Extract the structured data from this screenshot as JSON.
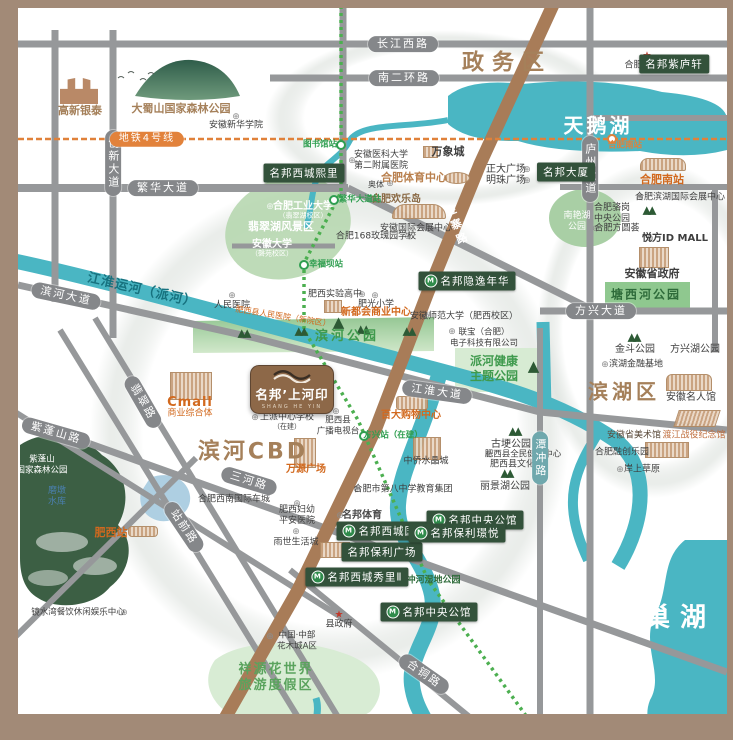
{
  "logo": {
    "name": "名邦’上河印",
    "sub": "SHANG HE YIN"
  },
  "districts": {
    "zhengwuqu": "政务区",
    "tianehu": "天鹅湖",
    "binhecbd": "滨河CBD",
    "binhuqu": "滨湖区",
    "chaohu": "巢湖"
  },
  "waters": {
    "canal": "江淮运河（派河）",
    "reservoir_l1": "磨墩",
    "reservoir_l2": "水库"
  },
  "roads": {
    "changjiangxilu": "长江西路",
    "nanerhuanlu": "南二环路",
    "fanhuadadao": "繁华大道",
    "chuangxindadao": "创新大道",
    "luzhoudadao": "庐州大道",
    "binhedadao": "滨河大道",
    "jianghuaidadao": "江淮大道",
    "fangxingdadao": "方兴大道",
    "sanhelu": "三河路",
    "zipengshanlu": "紫蓬山路",
    "feicuilu": "翡翠路",
    "zhanqianlu": "站前路",
    "hetonglu": "合铜路",
    "jinzhailu": "金寨路",
    "tanchonglu": "潭冲路"
  },
  "metro": {
    "line4": "地铁4号线",
    "st_tushuguan": "图书馆站",
    "st_fanhuadadao": "繁华大道站",
    "st_xingfuba": "幸福坝站",
    "st_fangxing": "方兴站（在建）",
    "st_hefeinan": "合肥南站"
  },
  "badges": {
    "ziluxuan": "名邦紫庐轩",
    "daxia": "名邦大厦",
    "xichengxili": "名邦西城熙里",
    "yinyinianhua": "名邦隐逸年华",
    "xichengguoji": "名邦西城国际",
    "baoliguangchang": "名邦保利广场",
    "xichengxiuli2": "名邦西城秀里Ⅱ",
    "zhongyanggongguan": "名邦中央公馆",
    "baolijingyue": "名邦保利璟悦",
    "zhongyanggongguan2": "名邦中央公馆"
  },
  "pois": {
    "gaoxinyintai": "高新银泰",
    "dashushan": "大蜀山国家森林公园",
    "xinhuaxueyuan": "安徽新华学院",
    "shizhengfu": "合肥市政府",
    "yikeda_l1": "安徽医科大学",
    "yikeda_l2": "第二附属医院",
    "wanxiangcheng": "万象城",
    "tiyuzhongxin": "合肥体育中心",
    "aoti": "奥体",
    "huanledao": "合肥欢乐岛",
    "guojihuizhan": "安徽国际会展中心",
    "rose168": "合肥168玫瑰园学校",
    "zhengdaguangchang": "正大广场",
    "mingzhuguangchang": "明珠广场",
    "hefeinanzhan": "合肥南站",
    "binhuhuizhan": "合肥滨湖国际会展中心",
    "luogang_l1": "合肥骆岗",
    "luogang_l2": "中央公园",
    "nanyanhu_l1": "南艳湖",
    "nanyanhu_l2": "公园",
    "fangyuanhui": "合肥方圆荟",
    "yuefangidmall": "悦方ID MALL",
    "shengzhengfu": "安徽省政府",
    "tangxihegongyuan": "塘西河公园",
    "jindougongyuan": "金斗公园",
    "fangxinghugongyuan": "方兴湖公园",
    "binhujinrongjidi": "滨湖金融基地",
    "mingrenguan": "安徽名人馆",
    "meishuguan": "安徽省美术馆",
    "dujiang": "渡江战役纪念馆",
    "rongchuangleyuan": "合肥融创乐园",
    "anshangcaoyuan": "岸上草原",
    "hegongda": "合肥工业大学",
    "hegongda_sub": "（翡翠湖校区）",
    "feicuihu": "翡翠湖风景区",
    "anhuidaxue": "安徽大学",
    "anhuidaxue_sub": "（磬苑校区）",
    "renminyiyuan": "人民医院",
    "feixirenmin": "肥西县人民医院（新院区）",
    "binhegongyuan": "滨河公园",
    "shiyangaozhong": "肥西实验高中",
    "feiguangxiaoxue": "肥光小学",
    "xinduhui": "新都会商业中心",
    "lianbao_l1": "联宝（合肥）",
    "lianbao_l2": "电子科技有限公司",
    "anshida": "安徽师范大学（肥西校区）",
    "paihe_l1": "派河健康",
    "paihe_l2": "主题公园",
    "baida": "百大购物中心",
    "zhongqiao": "中侨水晶城",
    "bazhong": "合肥市第八中学教育集团",
    "mingbangtiyu": "名邦体育",
    "gugeng": "古埂公园",
    "jianshen": "肥西县全民健身中心",
    "wenhuaguan": "肥西县文化馆",
    "lijinghu": "丽景湖公园",
    "cmall": "Cmall",
    "cmall_sub": "商业综合体",
    "shangpaixuexiao": "上派中心学校",
    "shangpaixuexiao_sub": "（在建）",
    "guangbo_l1": "肥西县",
    "guangbo_l2": "广播电视台",
    "wanyuanguangchang": "万源广场",
    "chexicheng": "合肥西南国际车城",
    "fuyou_l1": "肥西妇幼",
    "fuyou_l2": "平安医院",
    "yushi": "雨世生活城",
    "feixizhan": "肥西站",
    "zipengshan_l1": "紫蓬山",
    "zipengshan_l2": "国家森林公园",
    "jingshuiwan": "镜水湾餐饮休闲娱乐中心",
    "xianzhengfu": "县政府",
    "huamucheng_l1": "中国·中部",
    "huamucheng_l2": "花木城A区",
    "xiangyuan_l1": "祥源花世界",
    "xiangyuan_l2": "旅游度假区",
    "tanchongshidi": "潭冲河湿地公园"
  },
  "icons": {
    "metro": "M",
    "marker": "⊕",
    "star": "★",
    "trees": "▲▲",
    "tree": "▲"
  },
  "colors": {
    "water": "#4ab6c3",
    "road": "#96989a",
    "brown_road": "#a87c58",
    "badge": "#33523b",
    "accent_orange": "#d2691e",
    "brand_brown": "#a5805a",
    "metro_green": "#4caf50",
    "metro_orange": "#e0813a"
  }
}
